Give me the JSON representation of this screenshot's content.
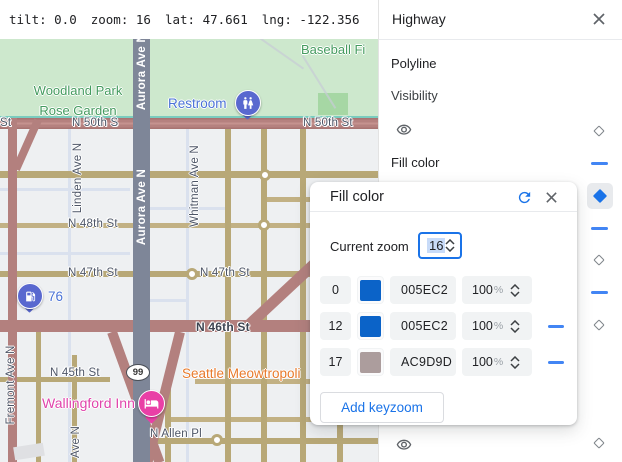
{
  "topbar": {
    "tilt": "tilt: 0.0",
    "zoom": "zoom: 16",
    "lat": "lat: 47.661",
    "lng": "lng: -122.356"
  },
  "map": {
    "streets": {
      "st50_left": "St",
      "st50_mid": "N 50th S",
      "st50_right": "N 50th St",
      "st48": "N 48th St",
      "st47_a": "N 47th St",
      "st47_b": "N 47th St",
      "st46": "N 46th St",
      "st45": "N 45th St",
      "allen": "N Allen Pl",
      "linden": "Linden Ave N",
      "whitman": "Whitman Ave N",
      "fremont": "Fremont Ave N",
      "ave_n": "Ave N",
      "aurora_top": "Aurora Ave N",
      "aurora_mid": "Aurora Ave N"
    },
    "places": {
      "park": "Woodland Park Rose Garden",
      "baseball": "Baseball Fi",
      "restroom": "Restroom",
      "gas": "76",
      "cat_hotel": "Seattle Meowtropoli",
      "inn": "Wallingford Inn",
      "shield": "99"
    }
  },
  "panel": {
    "title": "Highway",
    "section": "Polyline",
    "visibility_label": "Visibility",
    "fill_color_label": "Fill color"
  },
  "dialog": {
    "title": "Fill color",
    "current_zoom_label": "Current zoom",
    "current_zoom_value": "16",
    "percent_sign": "%",
    "keyzooms": [
      {
        "zoom": "0",
        "hex": "005EC2",
        "swatch": "#0b63c8",
        "opacity": "100"
      },
      {
        "zoom": "12",
        "hex": "005EC2",
        "swatch": "#0b63c8",
        "opacity": "100"
      },
      {
        "zoom": "17",
        "hex": "AC9D9D",
        "swatch": "#ac9d9d",
        "opacity": "100"
      }
    ],
    "add_button": "Add keyzoom"
  },
  "colors": {
    "accent": "#1a73e8",
    "dash": "#4285f4",
    "road_major": "#b3807e",
    "road_minor": "#b8a877",
    "aurora": "#7e8698"
  }
}
